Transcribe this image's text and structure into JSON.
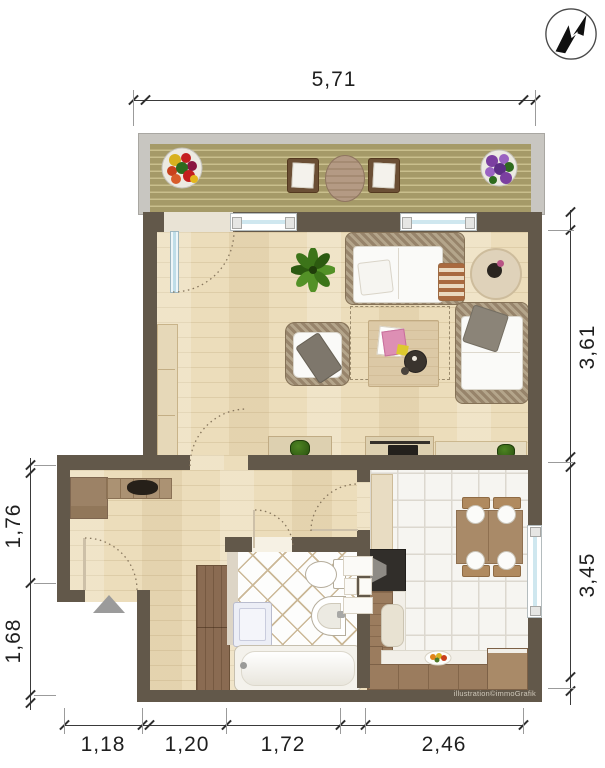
{
  "plan": {
    "type": "apartment-floor-plan",
    "branding": {
      "watermark": "illustration©immoGrafik"
    },
    "compass": {
      "icon": "north-arrow"
    },
    "dimensions": {
      "top_width": "5,71",
      "right_upper_height": "3,61",
      "right_lower_height": "3,45",
      "left_upper_height": "1,76",
      "left_lower_height": "1,68",
      "bottom_widths": [
        "1,18",
        "1,20",
        "1,72",
        "2,46"
      ]
    },
    "colors": {
      "wall": "#62584a",
      "wood_floor": "#ecddbb",
      "deck_plank": "#a59a68",
      "balcony_frame": "#c8c6c1",
      "kitchen_tile": "#f6f5f1",
      "bath_tile_grout": "#cbb897",
      "window_glass": "#cfe7ef",
      "furniture_wood": "#a98a68",
      "wicker": "#a08c72",
      "dimension_text": "#1f1f1f"
    }
  }
}
